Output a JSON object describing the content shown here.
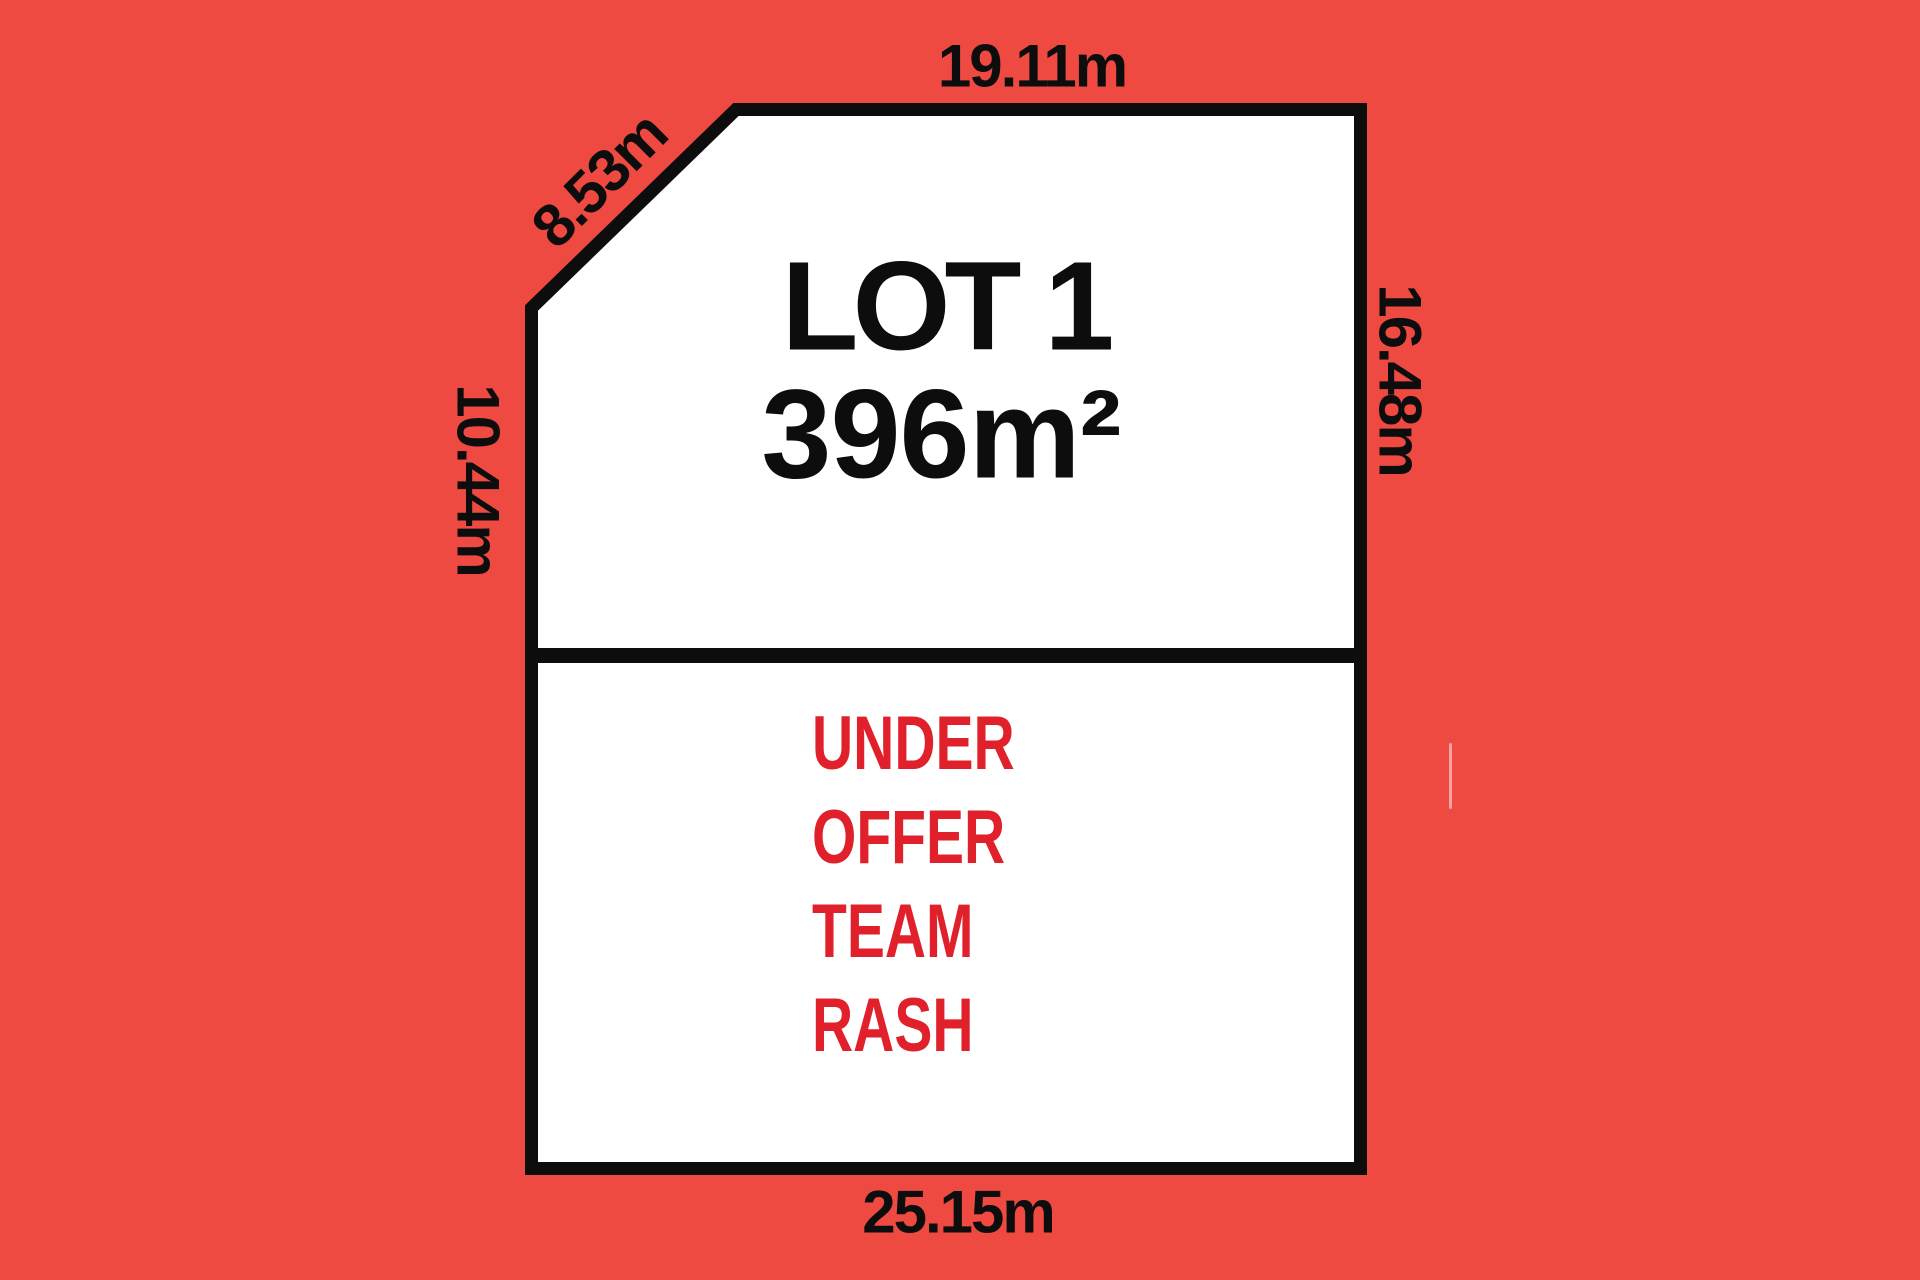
{
  "diagram": {
    "type": "land-lot-plan",
    "lot": {
      "title": "LOT 1",
      "area": "396m²",
      "status_lines": [
        "UNDER",
        "OFFER",
        "TEAM",
        "RASH"
      ]
    },
    "dimensions": {
      "top": "19.11m",
      "diagonal": "8.53m",
      "left": "10.44m",
      "right": "16.48m",
      "bottom": "25.15m"
    },
    "colors": {
      "background": "#ef4a42",
      "parcel_fill": "#ffffff",
      "outline": "#0d0d0d",
      "dimension_text": "#0d0d0d",
      "status_text": "#e0202a"
    }
  }
}
